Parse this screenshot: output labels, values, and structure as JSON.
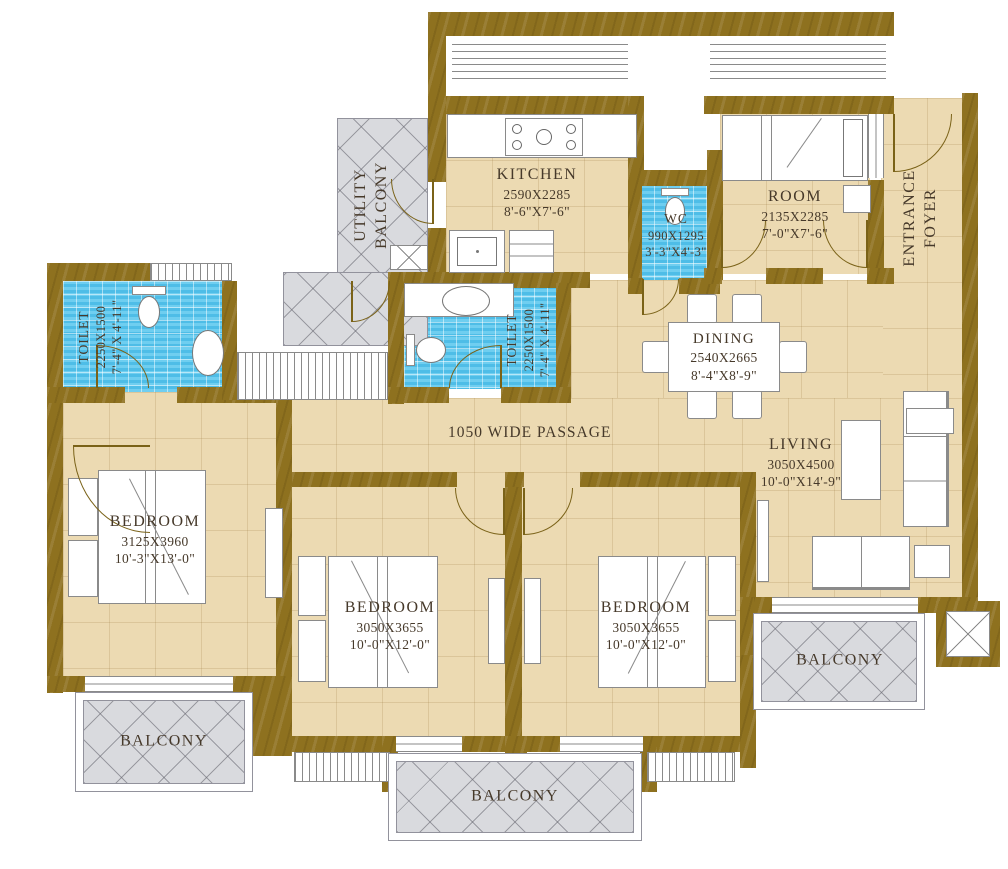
{
  "colors": {
    "wall": "#8e711f",
    "wall-line": "#7a6218",
    "floor": "#ecdab2",
    "floor-line": "#c9ae79",
    "blue": "#57c6ee",
    "blue-line": "#a8e4f8",
    "gray": "#d9dade",
    "gray-line": "#92929c",
    "ink": "#46392a",
    "line": "#8a8a8a"
  },
  "rooms": {
    "utility_balcony": {
      "lines": [
        "UTILITY",
        "BALCONY"
      ]
    },
    "kitchen": {
      "name": "KITCHEN",
      "size_mm": "2590X2285",
      "size_ft": "8'-6\"X7'-6\""
    },
    "wc": {
      "name": "WC",
      "size_mm": "990X1295",
      "size_ft": "3'-3\"X4'-3\""
    },
    "room": {
      "name": "ROOM",
      "size_mm": "2135X2285",
      "size_ft": "7'-0\"X7'-6\""
    },
    "entrance_foyer": {
      "lines": [
        "ENTRANCE",
        "FOYER"
      ]
    },
    "toilet_left": {
      "name": "TOILET",
      "size_mm": "2250X1500",
      "size_ft": "7'-4\" X 4'-11\""
    },
    "toilet_mid": {
      "name": "TOILET",
      "size_mm": "2250X1500",
      "size_ft": "7'-4\" X 4'-11\""
    },
    "dining": {
      "name": "DINING",
      "size_mm": "2540X2665",
      "size_ft": "8'-4\"X8'-9\""
    },
    "passage": {
      "name": "1050 WIDE PASSAGE"
    },
    "living": {
      "name": "LIVING",
      "size_mm": "3050X4500",
      "size_ft": "10'-0\"X14'-9\""
    },
    "bedroom_left": {
      "name": "BEDROOM",
      "size_mm": "3125X3960",
      "size_ft": "10'-3\"X13'-0\""
    },
    "bedroom_mid": {
      "name": "BEDROOM",
      "size_mm": "3050X3655",
      "size_ft": "10'-0\"X12'-0\""
    },
    "bedroom_right": {
      "name": "BEDROOM",
      "size_mm": "3050X3655",
      "size_ft": "10'-0\"X12'-0\""
    },
    "balcony_left": {
      "name": "BALCONY"
    },
    "balcony_center": {
      "name": "BALCONY"
    },
    "balcony_right": {
      "name": "BALCONY"
    }
  }
}
